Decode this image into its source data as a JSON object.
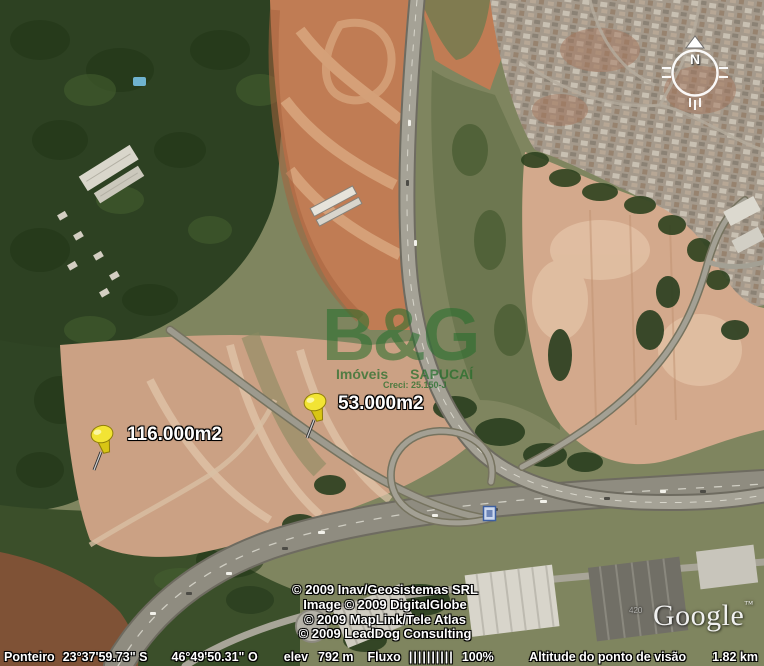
{
  "watermark": {
    "logo": "B&G",
    "brand_left": "Imóveis",
    "brand_right": "SAPUCAÍ",
    "creci": "Creci: 25.150-J"
  },
  "pins": [
    {
      "label": "116.000m2"
    },
    {
      "label": "53.000m2"
    }
  ],
  "copyright": {
    "lines": [
      "© 2009 Inav/Geosistemas SRL",
      "Image © 2009 DigitalGlobe",
      "© 2009 MapLink/Tele Atlas",
      "© 2009 LeadDog Consulting"
    ]
  },
  "branding": {
    "google": "Google",
    "tm": "™",
    "imagery_mark": "420"
  },
  "compass": {
    "north": "N"
  },
  "status": {
    "pointer_label": "Ponteiro",
    "lat": "23°37'59.73\" S",
    "lon": "46°49'50.31\" O",
    "elev_label": "elev",
    "elev_value": "792 m",
    "stream_label": "Fluxo",
    "stream_bars": "||||||||||",
    "stream_pct": "100%",
    "view_alt_label": "Altitude do ponto de visão",
    "view_alt_value": "1.82 km"
  },
  "colors": {
    "watermark_green": "#236e2a",
    "pin_yellow": "#f2e434",
    "earth_orange": "#c07c54",
    "cleared_pink": "#d3a98c"
  }
}
